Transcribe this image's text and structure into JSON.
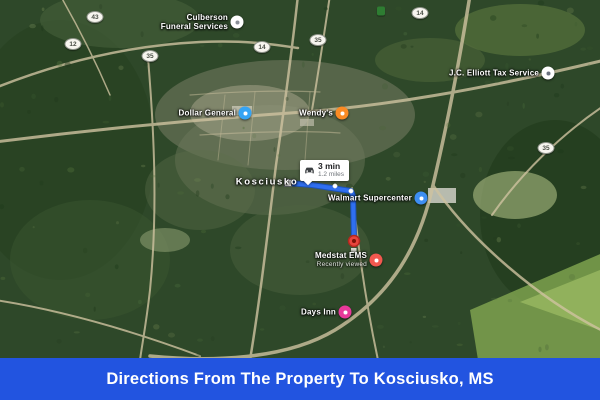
{
  "banner": {
    "title": "Directions From The Property To Kosciusko, MS"
  },
  "colors": {
    "banner_bg": "#2254e0",
    "route": "#2f6ff0",
    "route_casing": "#1d53b8",
    "destination_marker": "#e8453c"
  },
  "route": {
    "duration": "3 min",
    "distance": "1.2 miles",
    "points": [
      [
        288,
        183
      ],
      [
        312,
        185
      ],
      [
        351,
        191
      ],
      [
        353,
        196
      ],
      [
        354,
        240
      ]
    ],
    "via_dots": [
      [
        335,
        186
      ],
      [
        351,
        191
      ]
    ],
    "start": [
      288,
      183
    ],
    "end": [
      354,
      241
    ],
    "infobox": {
      "x": 300,
      "y": 160
    }
  },
  "map": {
    "city_label": {
      "text": "Kosciusko",
      "x": 267,
      "y": 182
    },
    "pois": [
      {
        "name": "culberson-funeral-services",
        "label_lines": [
          "Culberson",
          "Funeral Services"
        ],
        "x": 237,
        "y": 22,
        "marker_color": "#ffffff",
        "glyph": "funeral-home-icon",
        "glyph_color": "#8a8f98"
      },
      {
        "name": "dollar-general",
        "label_lines": [
          "Dollar General"
        ],
        "x": 245,
        "y": 113,
        "marker_color": "#35a4f4",
        "glyph": "shopping-icon",
        "glyph_color": "#ffffff"
      },
      {
        "name": "wendys",
        "label_lines": [
          "Wendy's"
        ],
        "x": 342,
        "y": 113,
        "marker_color": "#fb8b24",
        "glyph": "restaurant-icon",
        "glyph_color": "#ffffff"
      },
      {
        "name": "walmart-supercenter",
        "label_lines": [
          "Walmart Supercenter"
        ],
        "x": 421,
        "y": 198,
        "marker_color": "#3d8ef2",
        "glyph": "shopping-icon",
        "glyph_color": "#ffffff"
      },
      {
        "name": "medstat-ems",
        "label_lines": [
          "Medstat EMS"
        ],
        "sub": "Recently viewed",
        "x": 376,
        "y": 260,
        "marker_color": "#f3584f",
        "glyph": "medical-icon",
        "glyph_color": "#ffffff"
      },
      {
        "name": "days-inn",
        "label_lines": [
          "Days Inn"
        ],
        "x": 345,
        "y": 312,
        "marker_color": "#e8399a",
        "glyph": "hotel-icon",
        "glyph_color": "#ffffff"
      },
      {
        "name": "jc-elliott-tax-service",
        "label_lines": [
          "J.C. Elliott Tax Service"
        ],
        "x": 548,
        "y": 73,
        "marker_color": "#ffffff",
        "glyph": "business-icon",
        "glyph_color": "#6b7280"
      }
    ],
    "highway_shields": [
      {
        "label": "43",
        "x": 95,
        "y": 17
      },
      {
        "label": "12",
        "x": 73,
        "y": 44
      },
      {
        "label": "35",
        "x": 150,
        "y": 56
      },
      {
        "label": "14",
        "x": 262,
        "y": 47
      },
      {
        "label": "35",
        "x": 318,
        "y": 40
      },
      {
        "label": "14",
        "x": 420,
        "y": 13
      },
      {
        "label": "35",
        "x": 546,
        "y": 148
      }
    ],
    "parkway_sign": {
      "x": 381,
      "y": 11,
      "color": "#2e7d32"
    }
  }
}
